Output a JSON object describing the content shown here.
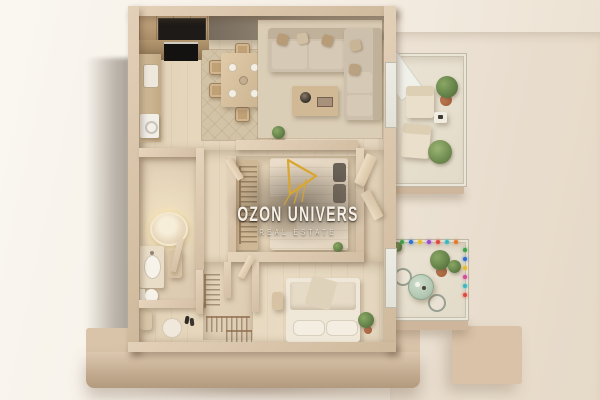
{
  "watermark": {
    "title": "OZON UNIVERS",
    "subtitle": "REAL ESTATE",
    "logo": "gold-line-sail-mark",
    "accent_color": "#D9A62F"
  },
  "scene": {
    "type": "isometric-3d-apartment-floor-plan-render",
    "style": "beige monochrome architectural model displayed on a plinth",
    "rooms": [
      "open-kitchen",
      "dining-area",
      "living-room",
      "bathroom",
      "hallway",
      "bedroom",
      "walk-in-closet",
      "entry-hall",
      "master-bedroom",
      "lounge-balcony",
      "bistro-balcony"
    ],
    "furnishings": {
      "kitchen": [
        "wall-cabinets",
        "dark-built-in-oven",
        "countertop",
        "sink",
        "washing-machine"
      ],
      "dining_area": [
        "table-for-six",
        "six-chairs",
        "four-place-settings",
        "patterned-rug"
      ],
      "living_room": [
        "l-shaped-sectional-sofa",
        "throw-pillows",
        "coffee-table",
        "decor-bowl",
        "area-rug",
        "console-plant"
      ],
      "bathroom": [
        "round-backlit-bathtub",
        "vanity-with-sink",
        "toilet",
        "partition-wall"
      ],
      "bedroom": [
        "double-bed",
        "dark-pillows",
        "wardrobe-with-hanging-clothes",
        "plant"
      ],
      "master_bedroom": [
        "double-bed-with-layered-duvet",
        "two-pillows",
        "bench",
        "potted-plant"
      ],
      "walk_in_closet": [
        "hanging-clothes-rails"
      ],
      "entry_hall": [
        "round-rug",
        "shoes",
        "console"
      ],
      "lounge_balcony": [
        "two-lounge-chairs",
        "side-table",
        "potted-plants",
        "open-glass-door"
      ],
      "bistro_balcony": [
        "round-mint-table",
        "two-wire-chairs",
        "potted-plants",
        "string-lights"
      ]
    }
  },
  "palette": {
    "backdrop": "#F5EEE4",
    "plinth": "#C8B093",
    "walls": "#DECBB2",
    "wood_floor": "#E6D6BC",
    "sofa_upholstery": "#CDC0AC",
    "fixture_white": "#F5F0E6",
    "greenery": "#66844A",
    "terracotta": "#AF6A43",
    "watermark_text": "#F5F0E7",
    "watermark_gold": "#D9A62F"
  },
  "bistro_balcony": {
    "string_light_colors": [
      "#E2483C",
      "#3FA24A",
      "#2F6FD2",
      "#E8BC2E",
      "#9A4BD0",
      "#E2483C",
      "#38B8C0",
      "#E07A2E",
      "#3FA24A",
      "#2F6FD2",
      "#E8BC2E",
      "#D44A9A",
      "#38B8C0",
      "#E2483C"
    ]
  }
}
